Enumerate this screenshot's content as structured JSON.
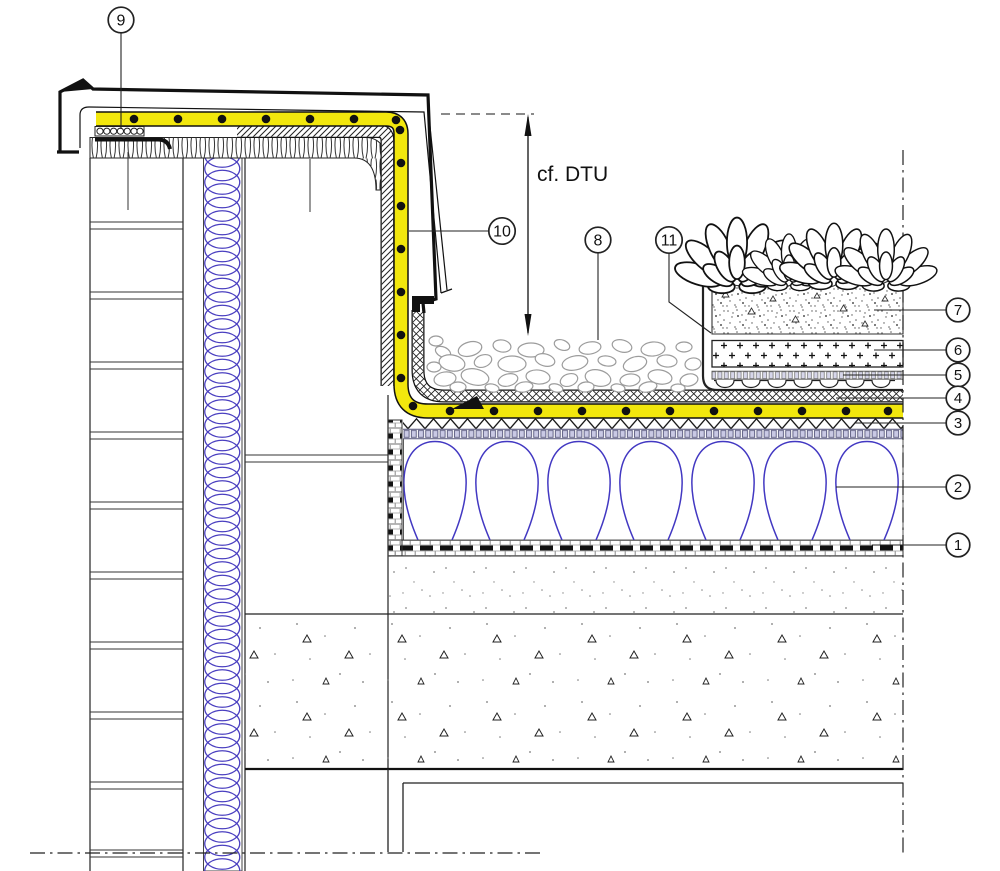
{
  "drawing": {
    "kind": "construction-detail-section-green-roof-parapet"
  },
  "annotation": {
    "text": "cf. DTU"
  },
  "callouts": [
    {
      "id": "1",
      "label": "1"
    },
    {
      "id": "2",
      "label": "2"
    },
    {
      "id": "3",
      "label": "3"
    },
    {
      "id": "4",
      "label": "4"
    },
    {
      "id": "5",
      "label": "5"
    },
    {
      "id": "6",
      "label": "6"
    },
    {
      "id": "7",
      "label": "7"
    },
    {
      "id": "8",
      "label": "8"
    },
    {
      "id": "9",
      "label": "9"
    },
    {
      "id": "10",
      "label": "10"
    },
    {
      "id": "11",
      "label": "11"
    }
  ],
  "colors": {
    "membrane_yellow": "#f2e70d",
    "insulation_blue": "#4238c2",
    "coil_blue": "#4a3fc0",
    "pebble_gray": "#9c9c9c",
    "line_black": "#111111"
  }
}
